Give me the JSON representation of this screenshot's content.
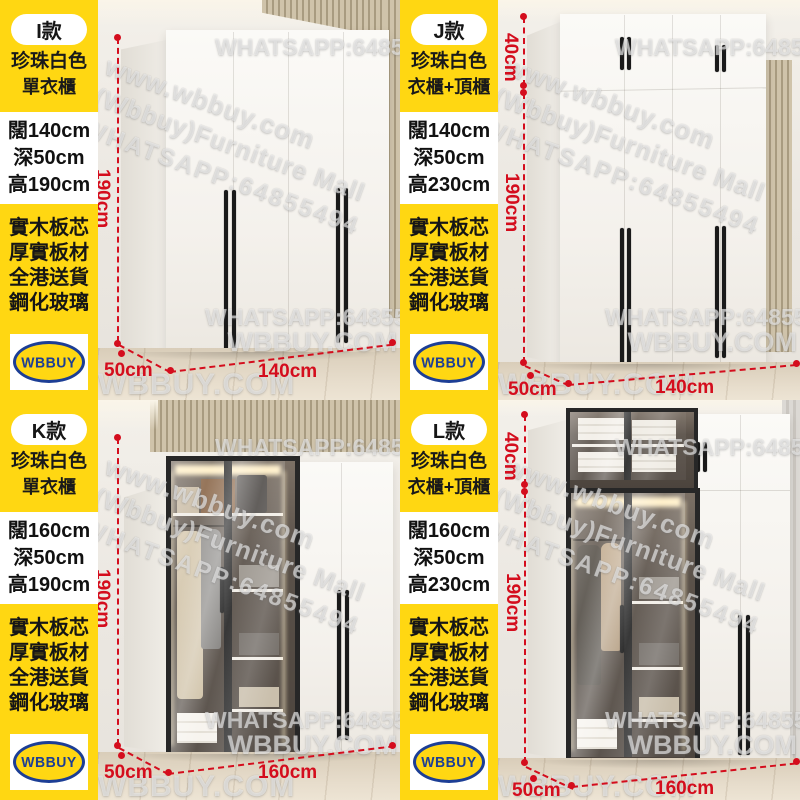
{
  "brand": {
    "logo_text": "WBBUY"
  },
  "colors": {
    "accent_yellow": "#FFD712",
    "dimension_red": "#D40D1D",
    "logo_blue": "#1C3E95",
    "logo_box_bg": "#FFFFFF"
  },
  "watermarks": {
    "whatsapp": "WHATSAPP:64855494",
    "site": "WBBUY.COM",
    "diag_line1": "www.wbbuy.com",
    "diag_line2": "(Wbbuy)Furniture Mall",
    "diag_line3": "WHATSAPP:64855494"
  },
  "shared": {
    "color_line": "珍珠白色",
    "features": [
      "實木板芯",
      "厚實板材",
      "全港送貨",
      "鋼化玻璃"
    ]
  },
  "panels": [
    {
      "model": "I款",
      "type_line": "單衣櫃",
      "spec_width": "闊140cm",
      "spec_depth": "深50cm",
      "spec_height": "高190cm",
      "dim_height": "190cm",
      "dim_depth": "50cm",
      "dim_width": "140cm"
    },
    {
      "model": "J款",
      "type_line": "衣櫃+頂櫃",
      "spec_width": "闊140cm",
      "spec_depth": "深50cm",
      "spec_height": "高230cm",
      "dim_top": "40cm",
      "dim_height": "190cm",
      "dim_depth": "50cm",
      "dim_width": "140cm"
    },
    {
      "model": "K款",
      "type_line": "單衣櫃",
      "spec_width": "闊160cm",
      "spec_depth": "深50cm",
      "spec_height": "高190cm",
      "dim_height": "190cm",
      "dim_depth": "50cm",
      "dim_width": "160cm"
    },
    {
      "model": "L款",
      "type_line": "衣櫃+頂櫃",
      "spec_width": "闊160cm",
      "spec_depth": "深50cm",
      "spec_height": "高230cm",
      "dim_top": "40cm",
      "dim_height": "190cm",
      "dim_depth": "50cm",
      "dim_width": "160cm"
    }
  ]
}
